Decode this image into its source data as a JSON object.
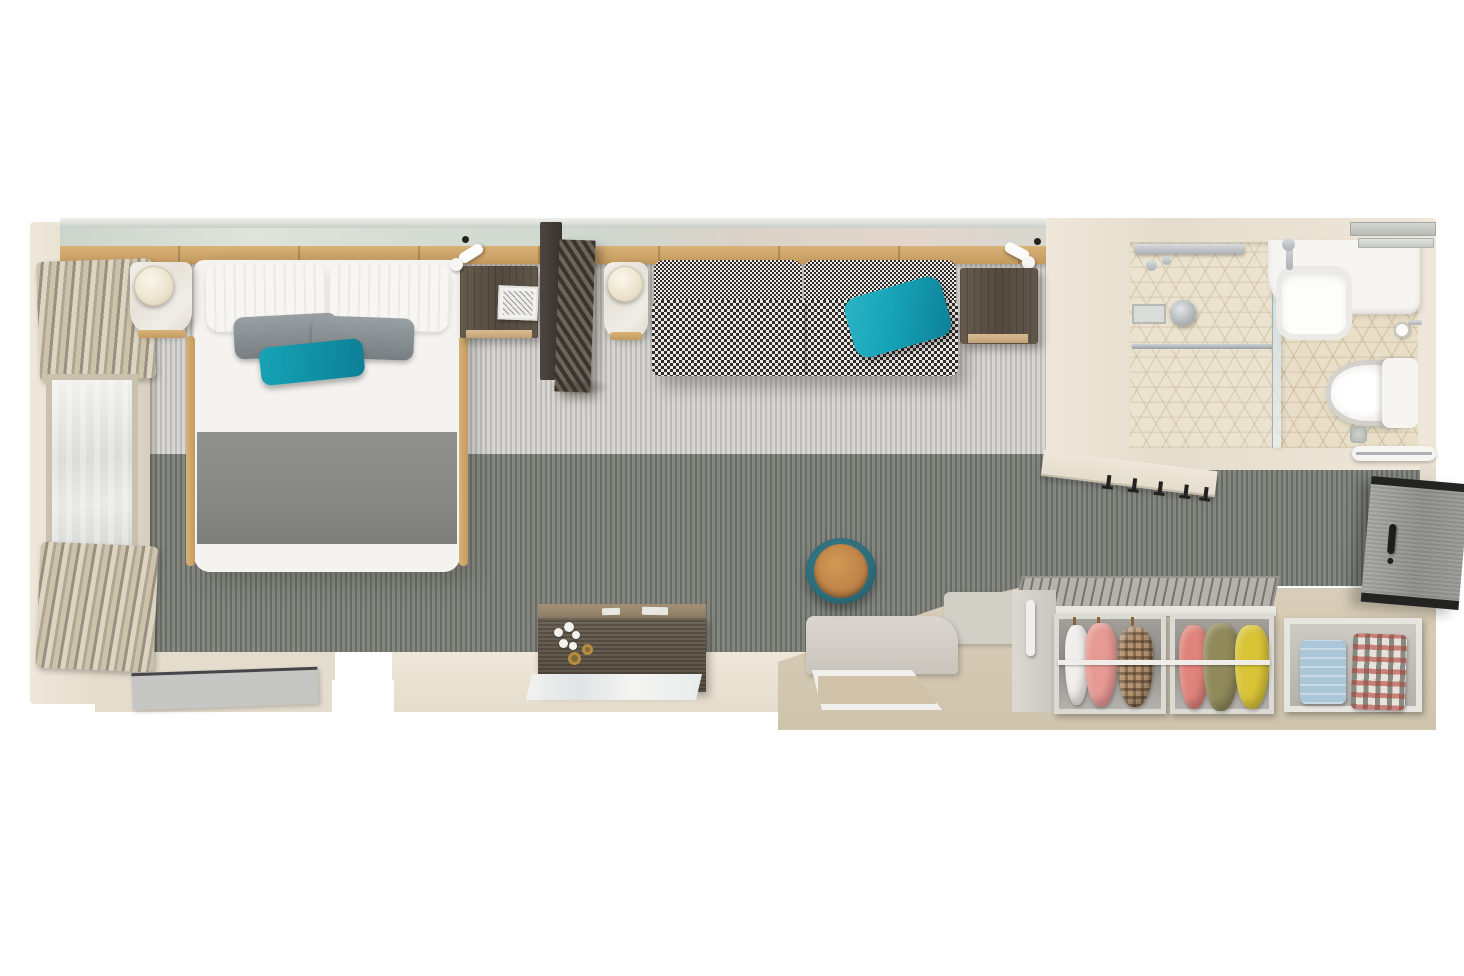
{
  "scene": {
    "type": "cruise-cabin-stateroom-floor-plan",
    "view": "top-down-3d-render",
    "rooms": [
      "bedroom-living-area",
      "bathroom",
      "entry-hall"
    ]
  },
  "colors": {
    "bg": "#ffffff",
    "wallLight": "#efe8da",
    "wallMid": "#e4ddcd",
    "wallShadow": "#d6cebc",
    "railSilver": "#c9cec9",
    "wood": "#c49a5e",
    "woodLight": "#d8b277",
    "carpetLight": "#d8d6d2",
    "carpetDark": "#848780",
    "entryFloor": "#d9ceb9",
    "bedWhite": "#f4f3f0",
    "blanketGray": "#8b8b89",
    "pillowGray1": "#99a0a3",
    "pillowGray2": "#787f82",
    "teal": "#16a3b7",
    "tealDark": "#0d7f95",
    "lampCream": "#ece3cd",
    "dividerDark": "#3a342e",
    "dividerLight": "#6e6459",
    "sofaDark": "#2e2c2a",
    "sofaLight": "#ece9e4",
    "tile": "#e9dfc9",
    "fixtureWhite": "#f6f5f2",
    "chrome": "#aeb2b4",
    "doorGray": "#9b9b99",
    "doorRail": "#232321",
    "closetFrame": "#e9e7e2",
    "closetSlats": "#b5b2ac",
    "garmentWhite": "#f0eeeb",
    "garmentCoral": "#e79a94",
    "garmentPlaidBase": "#b3936f",
    "garmentRed": "#e0837b",
    "garmentOlive": "#90895a",
    "garmentYellow": "#d9c437",
    "denim": "#aac7da",
    "plaidShirtBase": "#e8e3da",
    "stoolTeal": "#2e6d7b",
    "stoolLeather": "#bc8145",
    "leatherDark": "#9a6226",
    "tvGray": "#c6c6c4",
    "trayInner": "#cfc2a9",
    "orchidGold": "#b98c3e",
    "black": "#22211f"
  },
  "bedroom": {
    "items": [
      "window",
      "pleated-curtains",
      "double-bed",
      "white-pillows",
      "gray-accent-pillows",
      "teal-accent-pillow",
      "gray-blanket",
      "marble-nightstand",
      "round-table-lamp",
      "bedside-desk",
      "framed-print",
      "slatted-room-divider",
      "reading-lights",
      "ceiling-spots",
      "houndstooth-sofa",
      "teal-sofa-cushion",
      "walnut-side-table",
      "wall-mounted-tv",
      "vanity-desk",
      "white-orchid",
      "leather-stool",
      "white-rug"
    ]
  },
  "bathroom": {
    "items": [
      "cube-tile-floor",
      "shower",
      "glass-shower-door",
      "shower-head",
      "wall-niche",
      "sink-counter",
      "basin",
      "faucet",
      "glass-shelves",
      "toilet",
      "toilet-tank",
      "toilet-paper-holder",
      "floor-drain",
      "towel-rail"
    ]
  },
  "entry": {
    "items": [
      "entry-door",
      "door-handle",
      "coat-hooks",
      "wardrobe",
      "hanging-clothes-left",
      "hanging-clothes-right",
      "clothes-rail",
      "folded-denim",
      "folded-plaid-shirt",
      "console-bench",
      "luggage-tray"
    ]
  },
  "wardrobe_clothes": {
    "left_compartment": [
      "white",
      "coral",
      "brown-plaid"
    ],
    "right_compartment": [
      "red",
      "olive",
      "yellow"
    ],
    "shelf": [
      "blue-denim",
      "red-plaid-shirt"
    ]
  }
}
